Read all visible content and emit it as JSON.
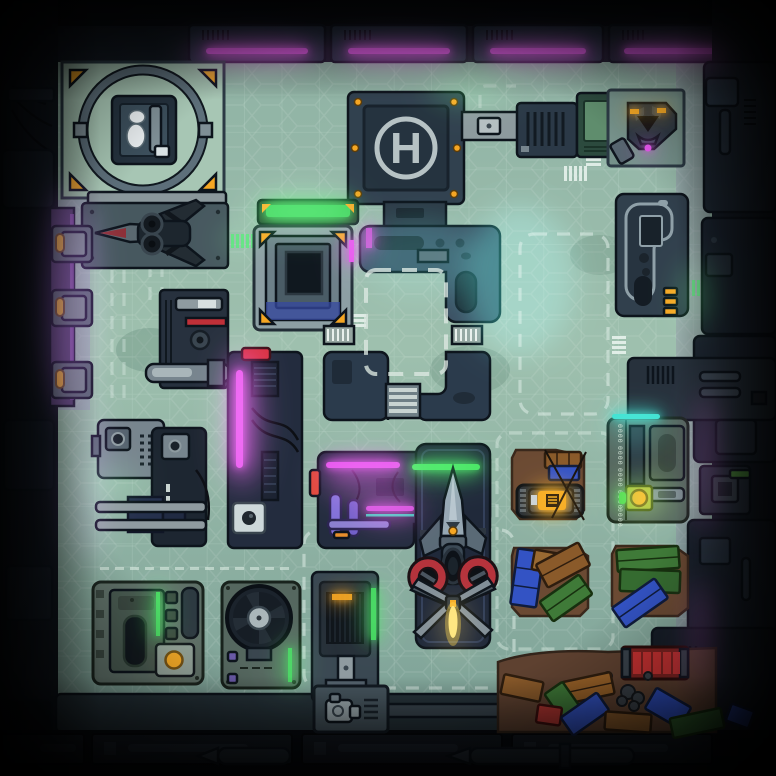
{
  "scene": {
    "kind": "sci-fi-facility-battlemap",
    "grid": {
      "columns": 17,
      "rows": 17,
      "cell_px": 38
    }
  },
  "helipad": {
    "marking": "H"
  },
  "lamp_rig": {
    "markings": [
      "0000",
      "0000",
      "0000",
      "0000",
      "0000"
    ]
  },
  "palette": {
    "ink": "#0d141c",
    "floor_a": "#9ec0ae",
    "floor_b": "#7fa398",
    "wall": "#141b24",
    "wall2": "#223040",
    "panel": "#2c3b4a",
    "panel_light": "#77858e",
    "steel": "#9aa8ab",
    "navy": "#232c3e",
    "navy_deep": "#1a2230",
    "neon_magenta": "#e553ec",
    "neon_green": "#45e45f",
    "neon_cyan": "#3fe0cf",
    "neon_purple": "#a85ae0",
    "orange": "#f5a623",
    "red": "#d23a38",
    "engine_red": "#b5333c",
    "crate_brown": "#8a5a2a",
    "crate_green": "#3f7a38",
    "crate_blue": "#3353c4",
    "dirt": "#6b4a33",
    "dirt_dark": "#5e4130",
    "glow_yellow": "#ffd24a",
    "hull": "#8fa0ad"
  },
  "legend": [
    "landing-ring-pad",
    "cryo-console",
    "fighter-drone",
    "helipad",
    "docking-arm",
    "printer-unit",
    "supply-cabinet",
    "turret-drone",
    "diagnostics-pod",
    "elevator-platform",
    "glow-table",
    "atrium-walls",
    "guard-rail",
    "stairs",
    "restricted-zone",
    "server-rack",
    "neon-pylon",
    "camera-box",
    "scanner-box",
    "conveyor",
    "access-door",
    "workbench-lab",
    "gunship",
    "ship-pad",
    "power-tank",
    "crate-pile",
    "signal-lamp-rig",
    "vent-machine",
    "control-kiosk",
    "exhaust-fan",
    "press-cabinet",
    "generator-box",
    "red-container",
    "cargo-dump",
    "torpedo-pipe"
  ]
}
